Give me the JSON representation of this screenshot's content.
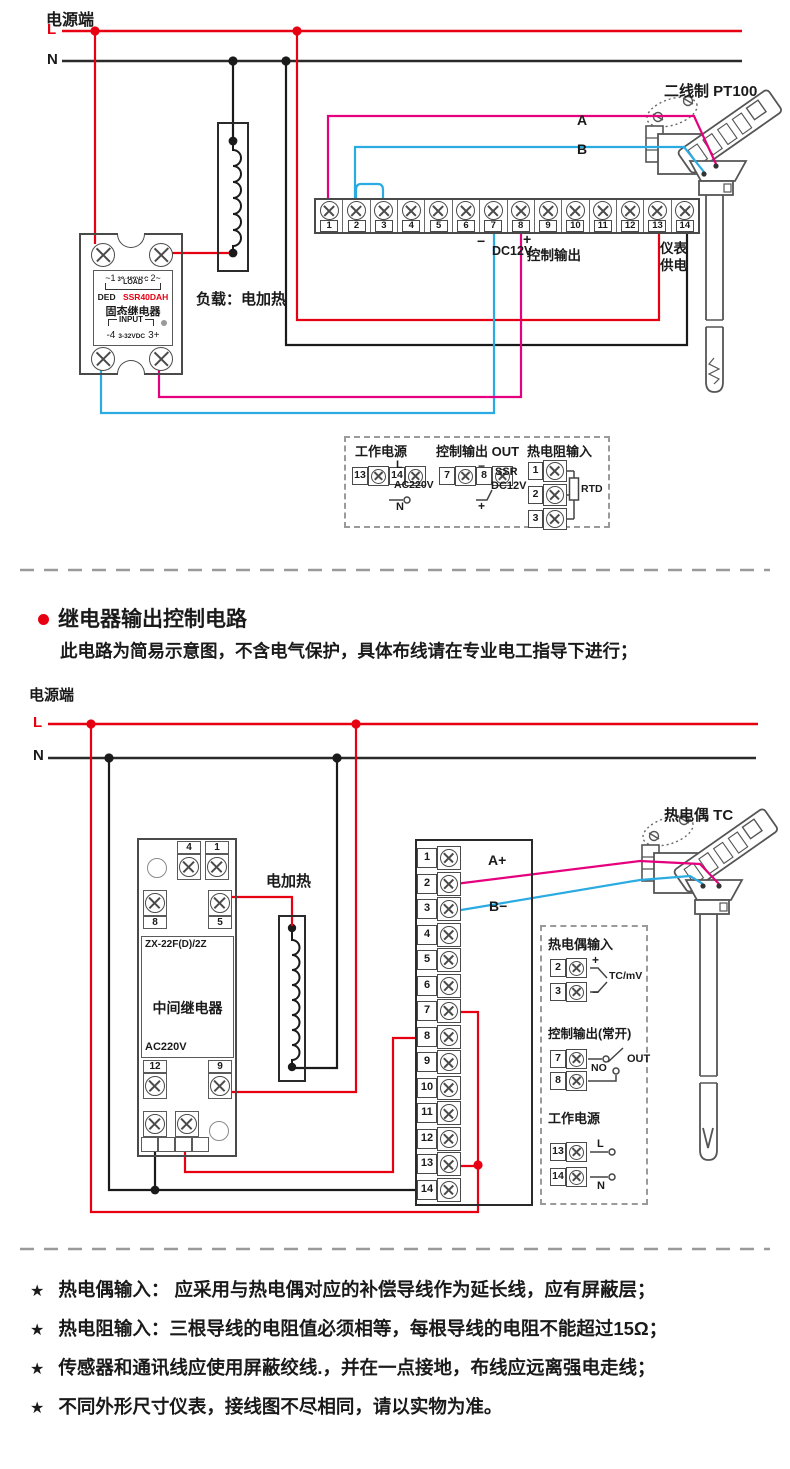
{
  "colors": {
    "red": "#e60012",
    "magenta": "#e5007e",
    "blue": "#2aabe2",
    "line": "#404040",
    "dash_gray": "#9a9a9a"
  },
  "sec1": {
    "power_label": "电源端",
    "l": "L",
    "n": "N",
    "ssr": {
      "left": "~1",
      "volt": "38-480VAC",
      "right": "2~",
      "load": "LOAD",
      "brand": "DED",
      "model": "SSR40DAH",
      "name": "固态继电器",
      "input": "INPUT",
      "in_left": "-4",
      "in_volt": "3-32VDC",
      "in_right": "3+"
    },
    "load_label": "负载：电加热",
    "terminals": [
      "1",
      "2",
      "3",
      "4",
      "5",
      "6",
      "7",
      "8",
      "9",
      "10",
      "11",
      "12",
      "13",
      "14"
    ],
    "minus": "−",
    "dc12v": "DC12V",
    "plus": "+",
    "ctrl_out": "控制输出",
    "supply_line1": "仪表",
    "supply_line2": "供电",
    "wire_a": "A",
    "wire_b": "B",
    "sensor_label": "二线制 PT100",
    "legend": {
      "power_title": "工作电源",
      "power_rows": [
        {
          "n": "13",
          "s": "L"
        },
        {
          "n": "14",
          "s": "N"
        }
      ],
      "power_mid": "AC220V",
      "out_title": "控制输出 OUT",
      "out_rows": [
        {
          "n": "7",
          "s": "−"
        },
        {
          "n": "8",
          "s": "+"
        }
      ],
      "out_l1": "SSR",
      "out_l2": "DC12V",
      "rtd_title": "热电阻输入",
      "rtd_rows": [
        "1",
        "2",
        "3"
      ],
      "rtd_label": "RTD"
    }
  },
  "sec2": {
    "heading": "继电器输出控制电路",
    "subheading": "此电路为简易示意图，不含电气保护，具体布线请在专业电工指导下进行；",
    "power_label": "电源端",
    "l": "L",
    "n": "N",
    "relay": {
      "t4": "4",
      "t1": "1",
      "t8": "8",
      "t5": "5",
      "model": "ZX-22F(D)/2Z",
      "name": "中间继电器",
      "volt": "AC220V",
      "t12": "12",
      "t9": "9",
      "bottom": [
        "A1",
        "14",
        "A2",
        "13"
      ]
    },
    "heater_label": "电加热",
    "terminals": [
      "1",
      "2",
      "3",
      "4",
      "5",
      "6",
      "7",
      "8",
      "9",
      "10",
      "11",
      "12",
      "13",
      "14"
    ],
    "wire_a": "A+",
    "wire_b": "B−",
    "sensor_label": "热电偶 TC",
    "legend": {
      "tc_title": "热电偶输入",
      "tc_rows": [
        {
          "n": "2",
          "s": "+"
        },
        {
          "n": "3",
          "s": "−"
        }
      ],
      "tc_label": "TC/mV",
      "out_title": "控制输出(常开)",
      "out_rows": [
        "7",
        "8"
      ],
      "no_label": "NO",
      "out_label": "OUT",
      "power_title": "工作电源",
      "power_rows": [
        {
          "n": "13",
          "s": "L"
        },
        {
          "n": "14",
          "s": "N"
        }
      ]
    }
  },
  "notes": {
    "star": "★",
    "items": [
      "热电偶输入： 应采用与热电偶对应的补偿导线作为延长线，应有屏蔽层；",
      "热电阻输入：三根导线的电阻值必须相等，每根导线的电阻不能超过15Ω；",
      "传感器和通讯线应使用屏蔽绞线.，并在一点接地，布线应远离强电走线；",
      "不同外形尺寸仪表，接线图不尽相同，请以实物为准。"
    ]
  }
}
